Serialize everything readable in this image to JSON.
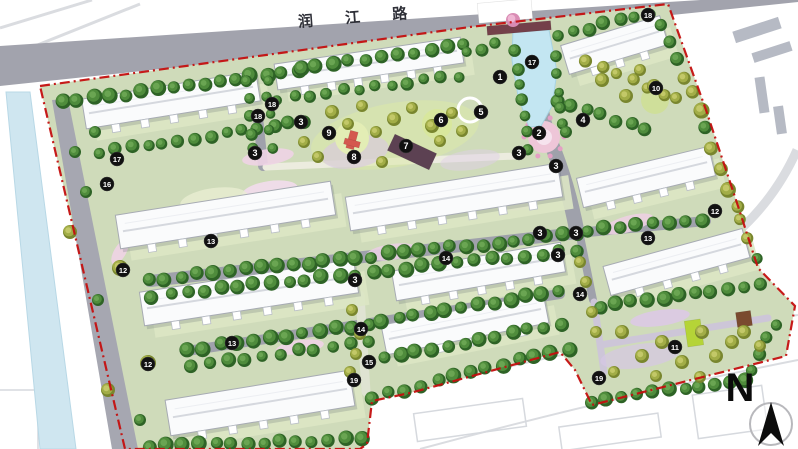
{
  "road": {
    "label": "润 江 路"
  },
  "compass": {
    "label": "N"
  },
  "colors": {
    "boundary_red": "#c40f0f",
    "road_gray": "#a2a3ad",
    "site_green": "#cfdbba",
    "water_blue": "#c3e6f2",
    "tree_dark_green": "#4f8c3c",
    "tree_olive": "#a2ad47",
    "building_white": "#fafbfc",
    "marker_black": "#111111"
  },
  "plan": {
    "boundary": {
      "points": [
        [
          40,
          86
        ],
        [
          470,
          27
        ],
        [
          668,
          4
        ],
        [
          706,
          110
        ],
        [
          738,
          206
        ],
        [
          758,
          268
        ],
        [
          795,
          306
        ],
        [
          786,
          356
        ],
        [
          592,
          405
        ],
        [
          575,
          370
        ],
        [
          560,
          352
        ],
        [
          410,
          393
        ],
        [
          372,
          401
        ],
        [
          367,
          444
        ],
        [
          360,
          449
        ],
        [
          125,
          449
        ]
      ]
    },
    "topRoad": {
      "points": [
        [
          0,
          46
        ],
        [
          500,
          13
        ],
        [
          668,
          2
        ],
        [
          798,
          -6
        ],
        [
          798,
          2
        ],
        [
          672,
          15
        ],
        [
          502,
          33
        ],
        [
          0,
          86
        ]
      ],
      "label_pos": {
        "x": 360,
        "y": 22,
        "rot": -4.5,
        "size": 15,
        "spacing": 14
      }
    },
    "leftWater": {
      "points": [
        [
          6,
          92
        ],
        [
          30,
          92
        ],
        [
          76,
          449
        ],
        [
          40,
          449
        ]
      ]
    },
    "leftRoad": {
      "points": [
        [
          52,
          100
        ],
        [
          68,
          99
        ],
        [
          138,
          449
        ],
        [
          112,
          449
        ]
      ]
    },
    "context": {
      "lines": [
        {
          "d": "M0,28 L92,0",
          "w": 3
        },
        {
          "d": "M0,60 L140,4",
          "w": 3
        },
        {
          "d": "M690,266 Q764,224 797,150",
          "w": 9
        },
        {
          "d": "M395,395 Q600,340 798,315",
          "w": 2
        },
        {
          "d": "M420,449 Q620,395 798,360",
          "w": 2
        }
      ],
      "blocks": [
        [
          757,
          30,
          48,
          12,
          -18
        ],
        [
          772,
          52,
          40,
          10,
          -18
        ],
        [
          762,
          95,
          10,
          36,
          -8
        ],
        [
          780,
          120,
          10,
          28,
          -8
        ]
      ],
      "outlines": [
        [
          470,
          420,
          110,
          28,
          -8
        ],
        [
          610,
          432,
          100,
          24,
          -8
        ],
        [
          730,
          412,
          70,
          44,
          -8
        ],
        [
          18,
          420,
          40,
          60,
          0
        ]
      ]
    },
    "roads": [
      {
        "d": "M532,31 C536,80 539,114 551,143 C563,172 571,200 577,232",
        "w": 15
      },
      {
        "d": "M150,281 L577,233",
        "w": 12
      },
      {
        "d": "M577,233 L706,221",
        "w": 10
      },
      {
        "d": "M187,351 L560,294",
        "w": 10
      },
      {
        "d": "M257,107 L263,166",
        "w": 10
      },
      {
        "d": "M580,236 L593,300",
        "w": 8
      }
    ],
    "lightPaths": [
      {
        "d": "M266,167 L516,156",
        "w": 7,
        "c": "#ececdf"
      },
      {
        "d": "M360,295 L366,392",
        "w": 9,
        "c": "#dfe3d2"
      },
      {
        "d": "M594,302 L604,372",
        "w": 7,
        "c": "#cdc6d8"
      },
      {
        "d": "M600,345 L768,318",
        "w": 7,
        "c": "#cdc6d8"
      }
    ],
    "ellipses": [
      [
        395,
        135,
        85,
        32,
        -10,
        "#dce9a8",
        0.55
      ],
      [
        355,
        152,
        34,
        16,
        -10,
        "#d9c6e4",
        0.6
      ],
      [
        470,
        160,
        30,
        10,
        -8,
        "#dfd0e8",
        0.5
      ],
      [
        268,
        157,
        26,
        8,
        -8,
        "#eed3e6",
        0.9
      ],
      [
        448,
        200,
        34,
        9,
        -8,
        "#e9cfe3",
        0.9
      ],
      [
        628,
        224,
        26,
        8,
        -16,
        "#eccfe2",
        0.9
      ],
      [
        392,
        252,
        26,
        8,
        -8,
        "#e9cfe3",
        0.9
      ],
      [
        300,
        347,
        24,
        7,
        -8,
        "#eed3e6",
        0.9
      ],
      [
        520,
        203,
        20,
        7,
        -8,
        "#e5cade",
        0.9
      ],
      [
        660,
        318,
        30,
        8,
        -8,
        "#dcc9e6",
        0.9
      ],
      [
        120,
        252,
        14,
        6,
        -60,
        "#eed3e6",
        0.9
      ],
      [
        270,
        191,
        28,
        10,
        -8,
        "#f0dcea",
        0.95
      ],
      [
        640,
        356,
        40,
        12,
        -8,
        "#d6c8e6",
        0.7
      ],
      [
        214,
        200,
        34,
        12,
        -8,
        "#e8eed2",
        0.8
      ]
    ],
    "circles": [
      [
        544,
        137,
        16,
        "#eec6d8",
        ""
      ],
      [
        544,
        137,
        8,
        "#f6e3ee",
        ""
      ],
      [
        437,
        124,
        15,
        "#d8e79d",
        ""
      ],
      [
        352,
        138,
        17,
        "#e3edb5",
        ""
      ],
      [
        470,
        110,
        12,
        "none",
        "#ffffff"
      ],
      [
        655,
        100,
        14,
        "#cfdf9a",
        ""
      ]
    ],
    "dotRing": {
      "cx": 544,
      "cy": 137,
      "r": 20,
      "n": 10,
      "dr": 2.5,
      "fill": "#e49fc4"
    },
    "rects": [
      [
        412,
        152,
        46,
        18,
        25,
        "#5c4152"
      ],
      [
        694,
        333,
        16,
        26,
        -8,
        "#b5d437"
      ],
      [
        744,
        319,
        15,
        15,
        -8,
        "#7a4a2f"
      ],
      [
        352,
        140,
        8,
        18,
        15,
        "#d4574e"
      ],
      [
        352,
        143,
        16,
        6,
        15,
        "#d4574e"
      ],
      [
        505,
        11,
        54,
        20,
        -5,
        "#ffffff"
      ],
      [
        519,
        28,
        64,
        9,
        -5,
        "#74404a"
      ]
    ],
    "canal": {
      "points": [
        [
          513,
          30
        ],
        [
          549,
          30
        ],
        [
          557,
          72
        ],
        [
          552,
          106
        ],
        [
          541,
          126
        ],
        [
          529,
          127
        ],
        [
          518,
          96
        ],
        [
          512,
          60
        ]
      ]
    },
    "buildings": [
      {
        "a": [
          84,
          114
        ],
        "b": [
          258,
          86
        ],
        "t": 30
      },
      {
        "a": [
          276,
          77
        ],
        "b": [
          462,
          50
        ],
        "t": 26
      },
      {
        "a": [
          565,
          60
        ],
        "b": [
          664,
          30
        ],
        "t": 30
      },
      {
        "a": [
          118,
          232
        ],
        "b": [
          333,
          198
        ],
        "t": 34
      },
      {
        "a": [
          348,
          214
        ],
        "b": [
          560,
          180
        ],
        "t": 34
      },
      {
        "a": [
          580,
          193
        ],
        "b": [
          712,
          161
        ],
        "t": 30
      },
      {
        "a": [
          142,
          309
        ],
        "b": [
          356,
          276
        ],
        "t": 34
      },
      {
        "a": [
          394,
          286
        ],
        "b": [
          563,
          257
        ],
        "t": 30
      },
      {
        "a": [
          607,
          281
        ],
        "b": [
          746,
          243
        ],
        "t": 30
      },
      {
        "a": [
          168,
          418
        ],
        "b": [
          352,
          388
        ],
        "t": 36
      },
      {
        "a": [
          384,
          340
        ],
        "b": [
          546,
          308
        ],
        "t": 30
      }
    ],
    "treeRows": [
      {
        "f": [
          62,
          103
        ],
        "t": [
          298,
          70
        ],
        "n": 16,
        "k": "d",
        "r": 7
      },
      {
        "f": [
          300,
          69
        ],
        "t": [
          464,
          46
        ],
        "n": 11,
        "k": "d",
        "r": 7
      },
      {
        "f": [
          558,
          35
        ],
        "t": [
          650,
          14
        ],
        "n": 7,
        "k": "d",
        "r": 6.5
      },
      {
        "f": [
          660,
          26
        ],
        "t": [
          702,
          110
        ],
        "n": 6,
        "k": "m",
        "r": 7
      },
      {
        "f": [
          100,
          153
        ],
        "t": [
          305,
          121
        ],
        "n": 14,
        "k": "d",
        "r": 6.5
      },
      {
        "f": [
          278,
          99
        ],
        "t": [
          458,
          76
        ],
        "n": 12,
        "k": "d",
        "r": 6
      },
      {
        "f": [
          150,
          280
        ],
        "t": [
          578,
          234
        ],
        "n": 28,
        "k": "d",
        "r": 7
      },
      {
        "f": [
          153,
          296
        ],
        "t": [
          576,
          250
        ],
        "n": 26,
        "k": "d",
        "r": 7
      },
      {
        "f": [
          586,
          231
        ],
        "t": [
          704,
          220
        ],
        "n": 8,
        "k": "d",
        "r": 7
      },
      {
        "f": [
          188,
          350
        ],
        "t": [
          370,
          324
        ],
        "n": 12,
        "k": "d",
        "r": 7
      },
      {
        "f": [
          382,
          321
        ],
        "t": [
          558,
          291
        ],
        "n": 12,
        "k": "d",
        "r": 7
      },
      {
        "f": [
          192,
          366
        ],
        "t": [
          368,
          341
        ],
        "n": 11,
        "k": "d",
        "r": 6.5
      },
      {
        "f": [
          384,
          358
        ],
        "t": [
          560,
          324
        ],
        "n": 12,
        "k": "d",
        "r": 7
      },
      {
        "f": [
          150,
          446
        ],
        "t": [
          362,
          439
        ],
        "n": 14,
        "k": "d",
        "r": 7
      },
      {
        "f": [
          372,
          398
        ],
        "t": [
          568,
          348
        ],
        "n": 13,
        "k": "d",
        "r": 7
      },
      {
        "f": [
          592,
          401
        ],
        "t": [
          746,
          380
        ],
        "n": 11,
        "k": "d",
        "r": 7
      },
      {
        "f": [
          750,
          370
        ],
        "t": [
          775,
          324
        ],
        "n": 4,
        "k": "d",
        "r": 6.5
      },
      {
        "f": [
          600,
          307
        ],
        "t": [
          760,
          285
        ],
        "n": 11,
        "k": "d",
        "r": 7
      },
      {
        "f": [
          704,
          128
        ],
        "t": [
          738,
          208
        ],
        "n": 5,
        "k": "m",
        "r": 7
      },
      {
        "f": [
          741,
          218
        ],
        "t": [
          757,
          260
        ],
        "n": 3,
        "k": "m",
        "r": 6.5
      },
      {
        "f": [
          556,
          100
        ],
        "t": [
          646,
          130
        ],
        "n": 7,
        "k": "d",
        "r": 7
      },
      {
        "f": [
          586,
          62
        ],
        "t": [
          664,
          94
        ],
        "n": 6,
        "k": "o",
        "r": 6.5
      },
      {
        "f": [
          516,
          52
        ],
        "t": [
          527,
          148
        ],
        "n": 7,
        "k": "d",
        "r": 6
      },
      {
        "f": [
          557,
          58
        ],
        "t": [
          562,
          124
        ],
        "n": 5,
        "k": "d",
        "r": 5.5
      },
      {
        "f": [
          247,
          82
        ],
        "t": [
          252,
          150
        ],
        "n": 5,
        "k": "d",
        "r": 5.5
      },
      {
        "f": [
          267,
          80
        ],
        "t": [
          272,
          148
        ],
        "n": 5,
        "k": "d",
        "r": 5.5
      },
      {
        "f": [
          468,
          52
        ],
        "t": [
          494,
          45
        ],
        "n": 3,
        "k": "d",
        "r": 6
      }
    ],
    "treeSingles": [
      [
        120,
        268,
        8,
        "o"
      ],
      [
        148,
        363,
        8,
        "o"
      ],
      [
        70,
        232,
        7,
        "o"
      ],
      [
        98,
        300,
        6,
        "d"
      ],
      [
        108,
        390,
        7,
        "o"
      ],
      [
        140,
        420,
        6,
        "d"
      ],
      [
        75,
        152,
        6,
        "d"
      ],
      [
        86,
        192,
        6,
        "d"
      ],
      [
        95,
        132,
        6,
        "d"
      ],
      [
        332,
        112,
        7,
        "o"
      ],
      [
        348,
        124,
        6,
        "o"
      ],
      [
        362,
        106,
        6,
        "o"
      ],
      [
        376,
        132,
        6,
        "o"
      ],
      [
        394,
        119,
        7,
        "o"
      ],
      [
        412,
        108,
        6,
        "o"
      ],
      [
        432,
        126,
        7,
        "o"
      ],
      [
        452,
        113,
        6,
        "o"
      ],
      [
        304,
        142,
        6,
        "o"
      ],
      [
        318,
        157,
        6,
        "o"
      ],
      [
        382,
        162,
        6,
        "o"
      ],
      [
        440,
        141,
        6,
        "o"
      ],
      [
        462,
        131,
        6,
        "o"
      ],
      [
        352,
        310,
        6,
        "o"
      ],
      [
        360,
        334,
        6,
        "o"
      ],
      [
        356,
        354,
        6,
        "o"
      ],
      [
        350,
        372,
        6,
        "o"
      ],
      [
        580,
        262,
        6,
        "o"
      ],
      [
        586,
        282,
        6,
        "o"
      ],
      [
        592,
        312,
        6,
        "o"
      ],
      [
        596,
        332,
        6,
        "o"
      ],
      [
        622,
        332,
        7,
        "o"
      ],
      [
        642,
        356,
        7,
        "o"
      ],
      [
        662,
        342,
        7,
        "o"
      ],
      [
        682,
        362,
        7,
        "o"
      ],
      [
        702,
        332,
        7,
        "o"
      ],
      [
        716,
        356,
        7,
        "o"
      ],
      [
        732,
        342,
        7,
        "o"
      ],
      [
        614,
        372,
        6,
        "o"
      ],
      [
        656,
        376,
        6,
        "o"
      ],
      [
        700,
        377,
        6,
        "o"
      ],
      [
        744,
        332,
        7,
        "o"
      ],
      [
        760,
        346,
        6,
        "o"
      ],
      [
        602,
        80,
        7,
        "o"
      ],
      [
        626,
        96,
        7,
        "o"
      ],
      [
        654,
        86,
        7,
        "o"
      ],
      [
        676,
        98,
        6,
        "o"
      ],
      [
        640,
        70,
        6,
        "o"
      ],
      [
        566,
        132,
        6,
        "d"
      ]
    ],
    "pinkTree": [
      513,
      20,
      7
    ],
    "markers": [
      {
        "n": "1",
        "x": 500,
        "y": 77
      },
      {
        "n": "2",
        "x": 539,
        "y": 133
      },
      {
        "n": "3",
        "x": 301,
        "y": 122
      },
      {
        "n": "3",
        "x": 255,
        "y": 153
      },
      {
        "n": "3",
        "x": 519,
        "y": 153
      },
      {
        "n": "3",
        "x": 556,
        "y": 166
      },
      {
        "n": "3",
        "x": 355,
        "y": 280
      },
      {
        "n": "3",
        "x": 540,
        "y": 233
      },
      {
        "n": "3",
        "x": 576,
        "y": 233
      },
      {
        "n": "3",
        "x": 558,
        "y": 255
      },
      {
        "n": "4",
        "x": 583,
        "y": 120
      },
      {
        "n": "5",
        "x": 481,
        "y": 112
      },
      {
        "n": "6",
        "x": 441,
        "y": 120
      },
      {
        "n": "7",
        "x": 406,
        "y": 146
      },
      {
        "n": "8",
        "x": 354,
        "y": 157
      },
      {
        "n": "9",
        "x": 329,
        "y": 133
      },
      {
        "n": "10",
        "x": 656,
        "y": 88
      },
      {
        "n": "11",
        "x": 675,
        "y": 347
      },
      {
        "n": "12",
        "x": 715,
        "y": 211
      },
      {
        "n": "12",
        "x": 123,
        "y": 270
      },
      {
        "n": "12",
        "x": 148,
        "y": 364
      },
      {
        "n": "13",
        "x": 211,
        "y": 241
      },
      {
        "n": "13",
        "x": 648,
        "y": 238
      },
      {
        "n": "13",
        "x": 232,
        "y": 343
      },
      {
        "n": "14",
        "x": 446,
        "y": 258
      },
      {
        "n": "14",
        "x": 361,
        "y": 329
      },
      {
        "n": "14",
        "x": 580,
        "y": 294
      },
      {
        "n": "15",
        "x": 369,
        "y": 362
      },
      {
        "n": "16",
        "x": 107,
        "y": 184
      },
      {
        "n": "17",
        "x": 117,
        "y": 159
      },
      {
        "n": "17",
        "x": 532,
        "y": 62
      },
      {
        "n": "18",
        "x": 648,
        "y": 15
      },
      {
        "n": "18",
        "x": 272,
        "y": 104
      },
      {
        "n": "18",
        "x": 258,
        "y": 116
      },
      {
        "n": "19",
        "x": 354,
        "y": 380
      },
      {
        "n": "19",
        "x": 599,
        "y": 378
      }
    ]
  }
}
